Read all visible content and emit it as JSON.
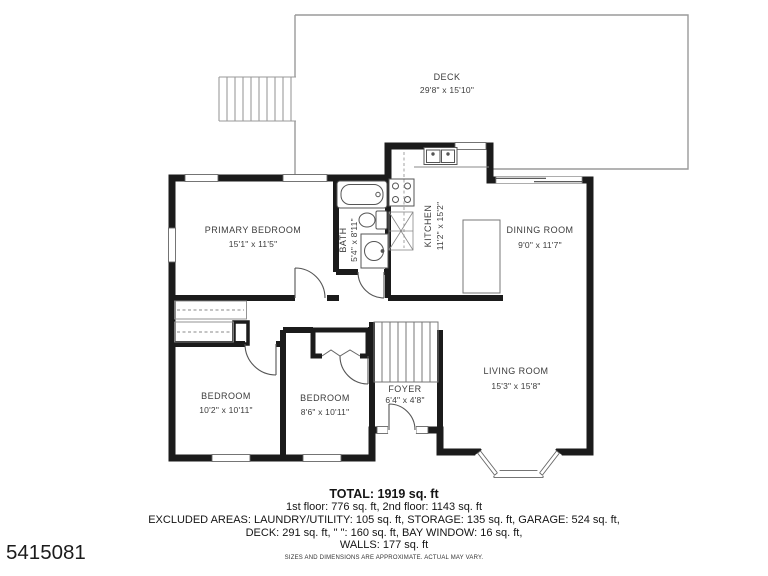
{
  "plan_id": "5415081",
  "rooms": {
    "deck": {
      "name": "DECK",
      "dims": "29'8\" x 15'10\""
    },
    "primary_bedroom": {
      "name": "PRIMARY BEDROOM",
      "dims": "15'1\" x 11'5\""
    },
    "bath": {
      "name": "BATH",
      "dims": "5'4\" x 8'11\""
    },
    "kitchen": {
      "name": "KITCHEN",
      "dims": "11'2\" x 15'2\""
    },
    "dining_room": {
      "name": "DINING ROOM",
      "dims": "9'0\" x 11'7\""
    },
    "living_room": {
      "name": "LIVING ROOM",
      "dims": "15'3\" x 15'8\""
    },
    "bedroom_left": {
      "name": "BEDROOM",
      "dims": "10'2\" x 10'11\""
    },
    "bedroom_middle": {
      "name": "BEDROOM",
      "dims": "8'6\" x 10'11\""
    },
    "foyer": {
      "name": "FOYER",
      "dims": "6'4\" x 4'8\""
    }
  },
  "summary": {
    "total": "TOTAL: 1919 sq. ft",
    "floors": "1st floor: 776 sq. ft, 2nd floor: 1143 sq. ft",
    "excluded_1": "EXCLUDED AREAS: LAUNDRY/UTILITY: 105 sq. ft, STORAGE: 135 sq. ft, GARAGE: 524 sq. ft,",
    "excluded_2": "DECK: 291 sq. ft, \" \": 160 sq. ft, BAY WINDOW: 16 sq. ft,",
    "walls": "WALLS: 177 sq. ft",
    "disclaimer": "SIZES AND DIMENSIONS ARE APPROXIMATE. ACTUAL MAY VARY."
  },
  "colors": {
    "wall": "#1b1b1b",
    "thin_line": "#8a8a8a",
    "label": "#3c3c3c"
  }
}
